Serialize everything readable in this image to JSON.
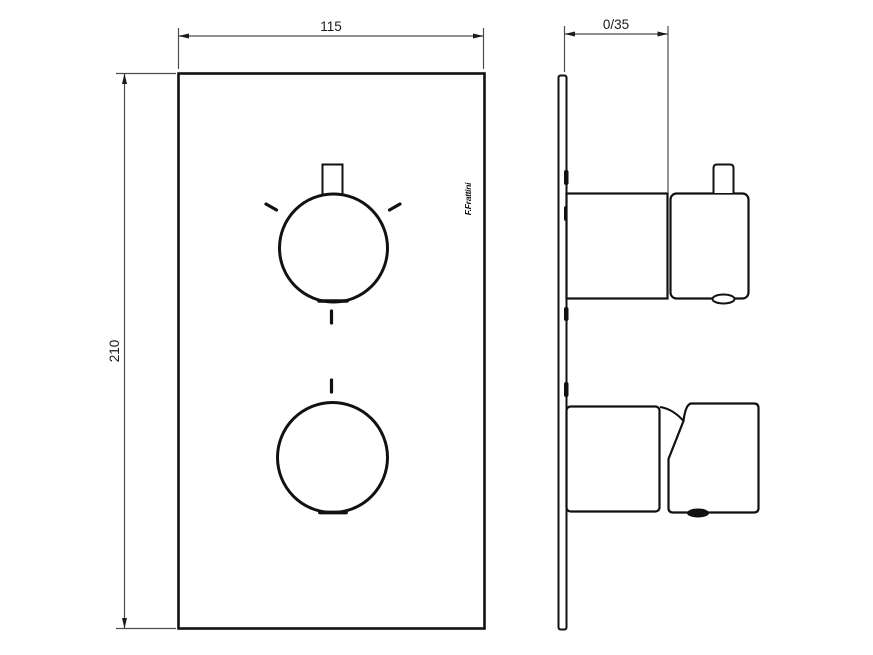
{
  "drawing": {
    "type": "technical-drawing",
    "subject": "thermostatic-shower-mixer-trim",
    "views": {
      "front": "front-view",
      "side": "side-view"
    }
  },
  "dimensions": {
    "width_label": "115",
    "height_label": "210",
    "depth_label": "0/35"
  },
  "logo": {
    "text": "F.Frattini"
  },
  "colors": {
    "object_line": "#111111",
    "dimension_line": "#4d4d4d",
    "background": "#ffffff"
  }
}
